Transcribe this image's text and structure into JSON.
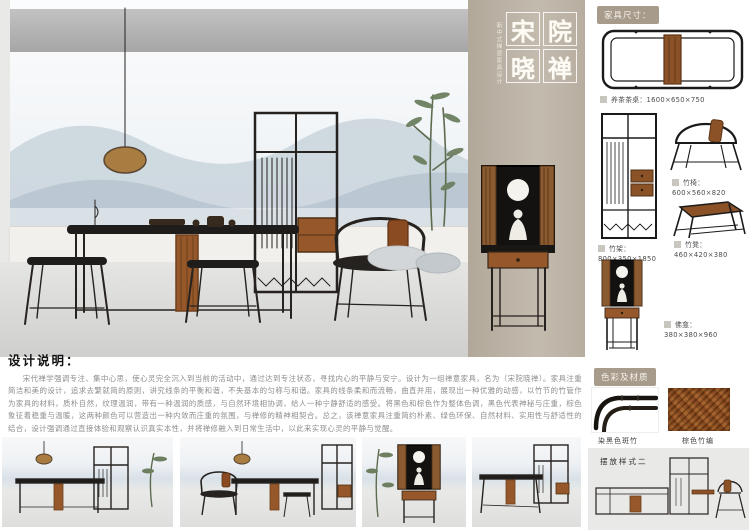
{
  "poster_title": {
    "chars": [
      "宋",
      "院",
      "晓",
      "禅"
    ],
    "subtitle": "新中式禅意家具设计"
  },
  "design_notes": {
    "heading": "设计说明：",
    "body": "宋代禅学强调专注、集中心思，使心灵完全沉入到当前的活动中，通过达到专注状态，寻找内心的平静与安宁。设计为一组禅意家具，名为（宋院晓禅）。家具注重简洁和美的设计，追求去繁就简的原则，讲究线条的平衡和谐，不失基本的匀称与和谐。家具的线条柔和而流畅，曲直并用，展现出一种优雅的动感，以竹节的竹管作为家具的材料，质朴自然，纹理温润，带有一种温润的质感，与自然环境相协调，给人一种宁静舒适的感受。将黑色和棕色作为整体色调，黑色代表神秘与庄重，棕色象征着稳重与温暖，这两种颜色可以营造出一种内敛而庄重的氛围，与禅修的精神相契合。总之，该禅意家具注重简约朴素、绿色环保、自然材料、实用性与舒适性的结合，设计强调通过直接体验和观察认识真实本性，并将禅修融入到日常生活中，以此来实现心灵的平静与觉醒。"
  },
  "dimensions_panel": {
    "header": "家具尺寸：",
    "items": [
      {
        "label": "养茶茶桌：",
        "size": "1600×650×750"
      },
      {
        "label": "竹架：",
        "size": "800×350×1850"
      },
      {
        "label": "竹椅：",
        "size": "600×560×820"
      },
      {
        "label": "竹凳：",
        "size": "460×420×380"
      },
      {
        "label": "佛龛：",
        "size": "380×380×960"
      }
    ]
  },
  "materials_panel": {
    "header": "色彩及材质",
    "swatches": [
      {
        "label": "染黑色斑竹"
      },
      {
        "label": "棕色竹编"
      }
    ],
    "arrangement_label": "摆放样式二"
  },
  "colors": {
    "frame_black": "#26221f",
    "rattan_brown": "#96582a",
    "pillar_beige": "#b8b0a2",
    "badge_tan": "#a79b8b",
    "mountain_blue": "#b6c4d0",
    "floor_gray": "#dcdcda"
  }
}
